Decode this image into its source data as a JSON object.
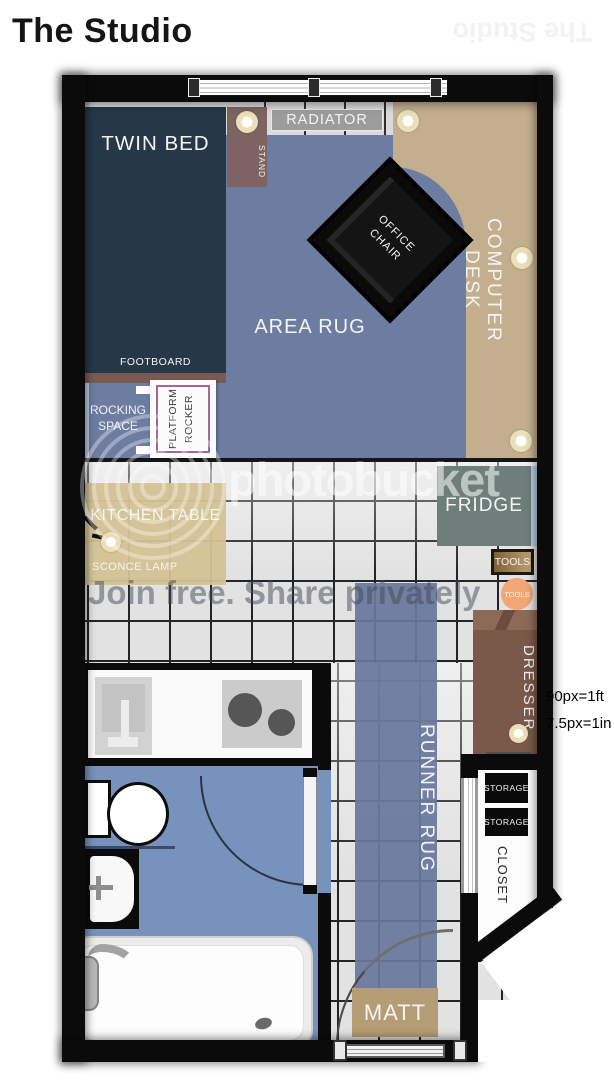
{
  "title": "The Studio",
  "title_mirrored": "The Studio",
  "scale": {
    "line1": "90px=1ft",
    "line2": "7.5px=1in"
  },
  "watermark": {
    "brand": "photobucket",
    "tagline": "Join free. Share privately"
  },
  "furniture": {
    "twin_bed": "TWIN BED",
    "footboard": "FOOTBOARD",
    "stand": "STAND",
    "radiator": "RADIATOR",
    "office_chair": "OFFICE CHAIR",
    "computer_desk": "COMPUTER DESK",
    "area_rug": "AREA RUG",
    "rocking_space": "ROCKING SPACE",
    "platform_rocker": "PLATFORM ROCKER",
    "kitchen_table": "KITCHEN TABLE",
    "sconce_lamp": "SCONCE LAMP",
    "fridge": "FRIDGE",
    "tools_box": "TOOLS",
    "tools_circle": "TOOLS",
    "dresser": "DRESSER",
    "runner_rug": "RUNNER RUG",
    "matt": "MATT",
    "storage_top": "STORAGE",
    "storage_bottom": "STORAGE",
    "closet": "CLOSET"
  },
  "colors": {
    "wall": "#0b0b0b",
    "area_rug": "#6d7ca1",
    "runner_rug": "#68779d",
    "bed": "#263847",
    "desk": "#c3af8e",
    "kitchen_table": "#d5c295",
    "fridge": "#6e7e7a",
    "dresser": "#7b594a",
    "bathroom_floor": "#7792bd",
    "tools_circle": "#f2a673",
    "matt": "#b49c74",
    "wall_lining": "#b9cbe5"
  }
}
